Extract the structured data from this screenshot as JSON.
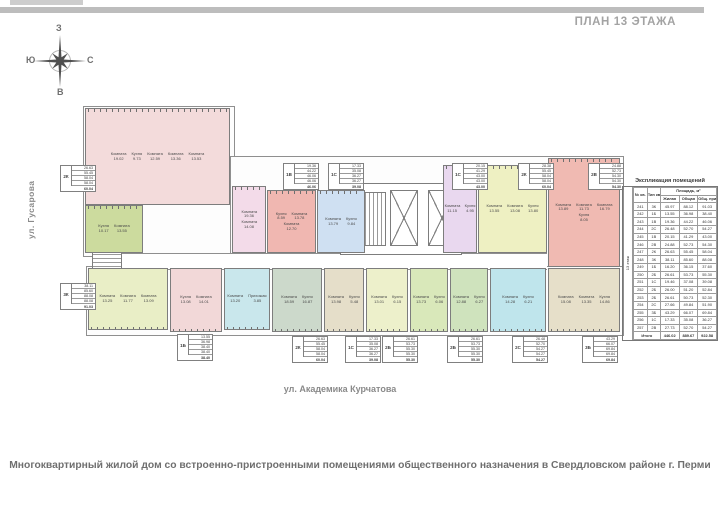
{
  "page": {
    "header": "ПЛАН 13 ЭТАЖА",
    "street_left": "ул. Гусарова",
    "street_bottom": "ул. Академика Курчатова",
    "caption": "Многоквартирный жилой дом со встроенно-пристроенными помещениями общественного назначения  в Свердловском районе г. Перми"
  },
  "compass": {
    "top": "З",
    "left": "Ю",
    "right": "С",
    "bottom": "В"
  },
  "plan": {
    "units": [
      {
        "type": "3К",
        "color": "#f3dbdb",
        "edge": "top",
        "rect": [
          85,
          108,
          145,
          97
        ],
        "rooms": [
          {
            "name": "Комната",
            "area": "19.02"
          },
          {
            "name": "Кухня",
            "area": "9.73"
          },
          {
            "name": "Комната",
            "area": "12.59"
          },
          {
            "name": "Комната",
            "area": "13.36"
          },
          {
            "name": "Комната",
            "area": "13.53"
          }
        ]
      },
      {
        "type": "1Б",
        "color": "#ccdb9e",
        "edge": "top",
        "rect": [
          85,
          205,
          58,
          48
        ],
        "rooms": [
          {
            "name": "Кухня",
            "area": "10.17"
          },
          {
            "name": "Комната",
            "area": "13.55"
          }
        ]
      },
      {
        "type": "1В",
        "color": "#f3dbe9",
        "edge": "top",
        "rect": [
          232,
          186,
          34,
          67
        ],
        "rooms": [
          {
            "name": "Комната",
            "area": "19.36"
          },
          {
            "name": "Комната",
            "area": "14.08"
          }
        ]
      },
      {
        "type": "2С",
        "color": "#f0b7b1",
        "edge": "top",
        "rect": [
          267,
          190,
          49,
          63
        ],
        "rooms": [
          {
            "name": "Кухня",
            "area": "8.59"
          },
          {
            "name": "Комната",
            "area": "13.78"
          },
          {
            "name": "Комната",
            "area": "12.70"
          }
        ]
      },
      {
        "type": "1В",
        "color": "#cfe0f2",
        "edge": "top",
        "rect": [
          317,
          190,
          48,
          63
        ],
        "rooms": [
          {
            "name": "Комната",
            "area": "13.79"
          },
          {
            "name": "Кухня",
            "area": "9.84"
          }
        ]
      },
      {
        "type": "2В",
        "color": "#e9d8ef",
        "edge": "top",
        "rect": [
          443,
          165,
          34,
          88
        ],
        "rooms": [
          {
            "name": "Комната",
            "area": "11.15"
          },
          {
            "name": "Кухня",
            "area": "4.95"
          }
        ]
      },
      {
        "type": "2К",
        "color": "#eef0c2",
        "edge": "top",
        "rect": [
          478,
          165,
          69,
          88
        ],
        "rooms": [
          {
            "name": "Комната",
            "area": "13.55"
          },
          {
            "name": "Комната",
            "area": "13.08"
          },
          {
            "name": "Кухня",
            "area": "13.80"
          }
        ]
      },
      {
        "type": "3К",
        "color": "#f0bab2",
        "edge": "top",
        "rect": [
          548,
          158,
          72,
          109
        ],
        "rooms": [
          {
            "name": "Комната",
            "area": "13.89"
          },
          {
            "name": "Комната",
            "area": "11.73"
          },
          {
            "name": "Комната",
            "area": "16.79"
          },
          {
            "name": "Кухня",
            "area": "8.05"
          }
        ]
      },
      {
        "type": "3К",
        "color": "#e9eec6",
        "edge": "bottom",
        "rect": [
          88,
          268,
          80,
          62
        ],
        "rooms": [
          {
            "name": "Комната",
            "area": "13.25"
          },
          {
            "name": "Комната",
            "area": "11.77"
          },
          {
            "name": "Комната",
            "area": "13.09"
          }
        ]
      },
      {
        "type": "2Б",
        "color": "#f2d8d8",
        "edge": "bottom",
        "rect": [
          170,
          268,
          52,
          64
        ],
        "rooms": [
          {
            "name": "Кухня",
            "area": "13.08"
          },
          {
            "name": "Комната",
            "area": "14.01"
          }
        ]
      },
      {
        "type": "1Б",
        "color": "#c9e7ec",
        "edge": "bottom",
        "rect": [
          224,
          268,
          46,
          62
        ],
        "rooms": [
          {
            "name": "Комната",
            "area": "13.20"
          },
          {
            "name": "Прихожая",
            "area": "3.85"
          }
        ]
      },
      {
        "type": "2К",
        "color": "#ccd9cb",
        "edge": "bottom",
        "rect": [
          272,
          268,
          50,
          64
        ],
        "rooms": [
          {
            "name": "Комната",
            "area": "18.59"
          },
          {
            "name": "Кухня",
            "area": "16.87"
          }
        ]
      },
      {
        "type": "1С",
        "color": "#e5dec9",
        "edge": "bottom",
        "rect": [
          324,
          268,
          40,
          64
        ],
        "rooms": [
          {
            "name": "Комната",
            "area": "13.98"
          },
          {
            "name": "Кухня",
            "area": "5.48"
          }
        ]
      },
      {
        "type": "1С",
        "color": "#edf0cb",
        "edge": "bottom",
        "rect": [
          366,
          268,
          42,
          64
        ],
        "rooms": [
          {
            "name": "Комната",
            "area": "13.01"
          },
          {
            "name": "Кухня",
            "area": "6.15"
          }
        ]
      },
      {
        "type": "2Б",
        "color": "#d9e8ba",
        "edge": "bottom",
        "rect": [
          410,
          268,
          38,
          64
        ],
        "rooms": [
          {
            "name": "Комната",
            "area": "13.73"
          },
          {
            "name": "Кухня",
            "area": "6.06"
          }
        ]
      },
      {
        "type": "2Б",
        "color": "#cfe3bd",
        "edge": "bottom",
        "rect": [
          450,
          268,
          38,
          64
        ],
        "rooms": [
          {
            "name": "Комната",
            "area": "12.88"
          },
          {
            "name": "Кухня",
            "area": "6.27"
          }
        ]
      },
      {
        "type": "2С",
        "color": "#bfe5ec",
        "edge": "bottom",
        "rect": [
          490,
          268,
          56,
          64
        ],
        "rooms": [
          {
            "name": "Комната",
            "area": "14.28"
          },
          {
            "name": "Кухня",
            "area": "6.21"
          }
        ]
      },
      {
        "type": "3Б",
        "color": "#e6dfc9",
        "edge": "bottom",
        "rect": [
          548,
          268,
          72,
          64
        ],
        "rooms": [
          {
            "name": "Комната",
            "area": "15.08"
          },
          {
            "name": "Комната",
            "area": "13.35"
          },
          {
            "name": "Кухня",
            "area": "14.86"
          }
        ]
      }
    ],
    "info_boxes": [
      {
        "type": "2К",
        "x": 60,
        "y": 165,
        "values": [
          "26.63",
          "55.45",
          "58.04",
          "58.04"
        ],
        "total": "60.04"
      },
      {
        "type": "1В",
        "x": 283,
        "y": 163,
        "values": [
          "19.36",
          "44.22",
          "46.06",
          "46.06"
        ],
        "total": "46.06"
      },
      {
        "type": "1С",
        "x": 328,
        "y": 163,
        "values": [
          "17.33",
          "35.08",
          "36.27",
          "36.27"
        ],
        "total": "39.08"
      },
      {
        "type": "1С",
        "x": 452,
        "y": 163,
        "values": [
          "20.15",
          "41.29",
          "43.00",
          "43.00"
        ],
        "total": "43.00"
      },
      {
        "type": "2К",
        "x": 518,
        "y": 163,
        "values": [
          "28.38",
          "55.45",
          "58.04",
          "58.04"
        ],
        "total": "60.04"
      },
      {
        "type": "2В",
        "x": 588,
        "y": 163,
        "values": [
          "24.88",
          "52.73",
          "54.30",
          "54.30"
        ],
        "total": "54.30"
      },
      {
        "type": "3К",
        "x": 60,
        "y": 283,
        "values": [
          "38.11",
          "85.60",
          "88.08",
          "88.08"
        ],
        "total": "91.03"
      },
      {
        "type": "1Б",
        "x": 177,
        "y": 334,
        "values": [
          "13.55",
          "36.98",
          "38.40",
          "38.40"
        ],
        "total": "38.40"
      },
      {
        "type": "2К",
        "x": 292,
        "y": 336,
        "values": [
          "26.63",
          "55.45",
          "58.04",
          "58.04"
        ],
        "total": "60.04"
      },
      {
        "type": "1С",
        "x": 345,
        "y": 336,
        "values": [
          "17.33",
          "35.08",
          "36.27",
          "36.27"
        ],
        "total": "39.08"
      },
      {
        "type": "2Б",
        "x": 382,
        "y": 336,
        "values": [
          "26.61",
          "53.73",
          "55.30",
          "55.30"
        ],
        "total": "55.30"
      },
      {
        "type": "2Б",
        "x": 447,
        "y": 336,
        "values": [
          "26.61",
          "53.73",
          "55.30",
          "55.30"
        ],
        "total": "55.30"
      },
      {
        "type": "2С",
        "x": 512,
        "y": 336,
        "values": [
          "26.48",
          "52.70",
          "54.27",
          "54.27"
        ],
        "total": "54.27"
      },
      {
        "type": "3Б",
        "x": 582,
        "y": 336,
        "values": [
          "43.29",
          "66.07",
          "69.84",
          "69.84"
        ],
        "total": "69.84"
      }
    ]
  },
  "explication": {
    "title": "Экспликация помещений",
    "floor": "13 этаж",
    "col_apt": "№ кв.",
    "col_type": "Тип кв.",
    "group": "Площадь, м²",
    "col_living": "Жилая",
    "col_total": "Общая",
    "col_reduced": "Общ. прив.",
    "rows": [
      {
        "apt": "241",
        "type": "3К",
        "living": "45.97",
        "total": "88.12",
        "reduced": "91.03"
      },
      {
        "apt": "242",
        "type": "1Б",
        "living": "13.55",
        "total": "36.98",
        "reduced": "38.40"
      },
      {
        "apt": "243",
        "type": "1В",
        "living": "19.36",
        "total": "44.22",
        "reduced": "46.06"
      },
      {
        "apt": "244",
        "type": "2С",
        "living": "26.48",
        "total": "52.70",
        "reduced": "54.27"
      },
      {
        "apt": "245",
        "type": "1В",
        "living": "20.15",
        "total": "41.29",
        "reduced": "43.00"
      },
      {
        "apt": "246",
        "type": "2В",
        "living": "24.88",
        "total": "52.73",
        "reduced": "54.30"
      },
      {
        "apt": "247",
        "type": "2К",
        "living": "26.63",
        "total": "55.45",
        "reduced": "58.04"
      },
      {
        "apt": "248",
        "type": "3К",
        "living": "38.11",
        "total": "85.60",
        "reduced": "88.08"
      },
      {
        "apt": "249",
        "type": "1Б",
        "living": "16.20",
        "total": "36.15",
        "reduced": "37.60"
      },
      {
        "apt": "250",
        "type": "2Б",
        "living": "26.61",
        "total": "53.73",
        "reduced": "55.30"
      },
      {
        "apt": "251",
        "type": "1С",
        "living": "19.46",
        "total": "37.08",
        "reduced": "39.08"
      },
      {
        "apt": "252",
        "type": "2Б",
        "living": "26.00",
        "total": "51.20",
        "reduced": "52.84"
      },
      {
        "apt": "253",
        "type": "2Б",
        "living": "26.61",
        "total": "50.73",
        "reduced": "52.30"
      },
      {
        "apt": "254",
        "type": "2С",
        "living": "27.66",
        "total": "49.84",
        "reduced": "51.90"
      },
      {
        "apt": "255",
        "type": "3Б",
        "living": "43.29",
        "total": "66.07",
        "reduced": "69.84"
      },
      {
        "apt": "256",
        "type": "1С",
        "living": "17.33",
        "total": "35.08",
        "reduced": "36.27"
      },
      {
        "apt": "257",
        "type": "2В",
        "living": "27.73",
        "total": "52.70",
        "reduced": "54.27"
      }
    ],
    "total_label": "Итого",
    "totals": {
      "living": "446.02",
      "total": "889.67",
      "reduced": "922.58"
    }
  }
}
